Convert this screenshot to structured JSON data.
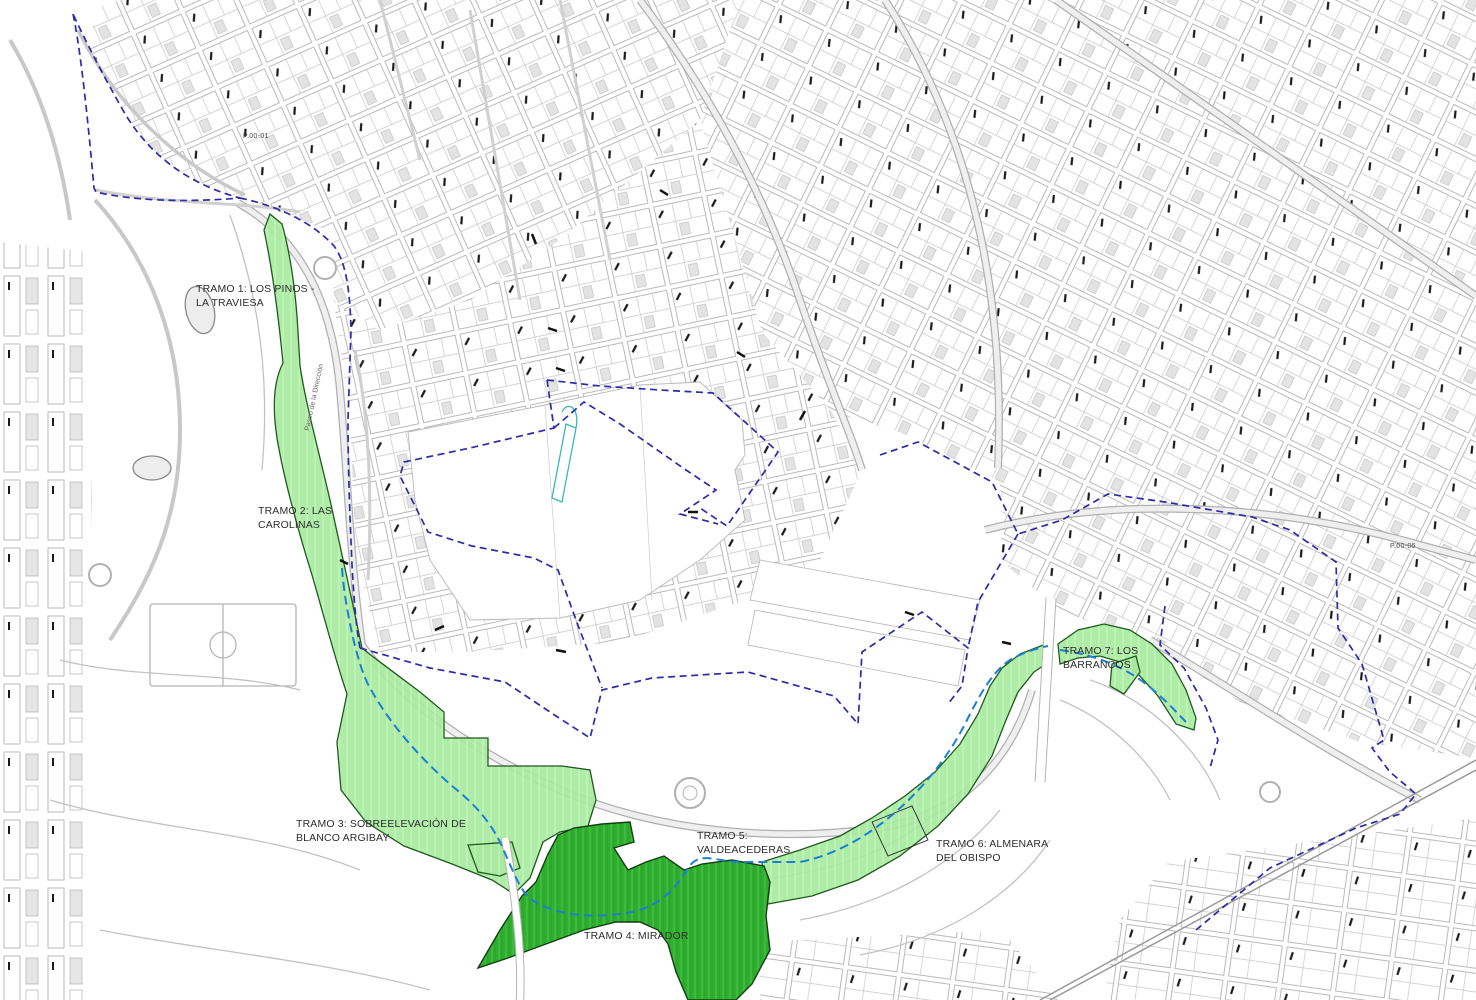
{
  "map": {
    "tramos": {
      "t1": "TRAMO 1: LOS PINOS - LA TRAVIESA",
      "t2": "TRAMO 2: LAS CAROLINAS",
      "t3": "TRAMO 3: SOBREELEVACIÓN DE BLANCO ARGIBAY",
      "t4": "TRAMO 4: MIRADOR",
      "t5": "TRAMO 5: VALDEACEDERAS",
      "t6": "TRAMO 6: ALMENARA DEL OBISPO",
      "t7": "TRAMO 7: LOS BARRANCOS"
    },
    "codes": {
      "c1": "P.00-01",
      "c2": "P.00-06"
    },
    "street": "Paseo de la Dirección",
    "colors": {
      "light_green": "#a8ea9f",
      "dark_green": "#2fae2f",
      "boundary_blue": "#2b2baa",
      "corridor_blue": "#1d7ed2",
      "teal": "#3ab8b8",
      "city_line_gray": "#b3b3b3"
    }
  }
}
